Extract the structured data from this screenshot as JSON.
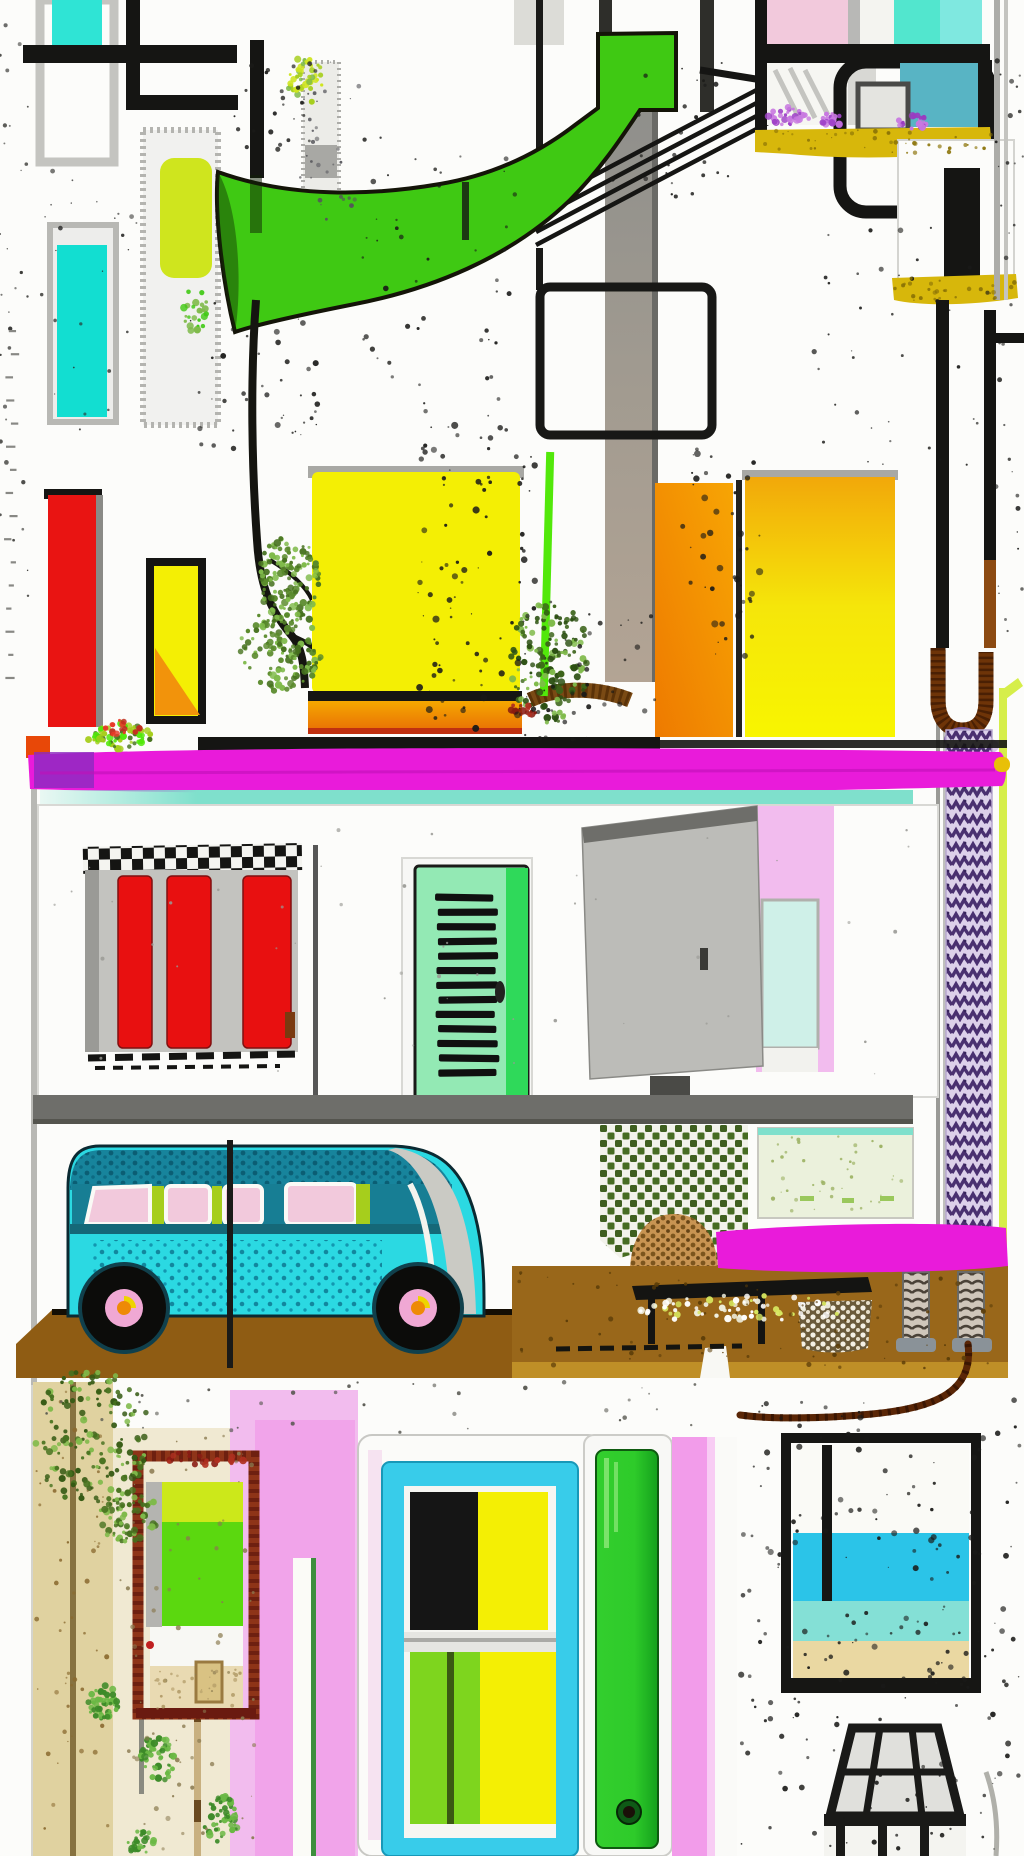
{
  "meta": {
    "width": 1024,
    "height": 1856,
    "title_hidden": ""
  },
  "palette": {
    "white": "#FCFCFA",
    "ink": "#151513",
    "gray-light": "#D8D8D4",
    "gray-mid": "#9A9A96",
    "gray-dark": "#4A4A46",
    "gray-panel": "#C3C3BF",
    "floor-gray": "#6E6E6A",
    "cyan-small": "#2FE4D5",
    "cyan-tall": "#12DED1",
    "chartreuse": "#CFE51E",
    "swoosh-green": "#3FC913",
    "lime": "#A6CE1C",
    "lime-line": "#52E80A",
    "chartreuse-pole-line": "#D6EE4A",
    "yellow": "#F4EF04",
    "amber": "#F2B20C",
    "orange": "#F2930B",
    "orange-deep": "#E86A05",
    "red": "#E91412",
    "red-slat": "#E81010",
    "red-dark": "#B03020",
    "magenta": "#E91BDA",
    "purple": "#8B2BBF",
    "purple-dark": "#4A3070",
    "lavender": "#DCD0EA",
    "pink-light": "#F2BCEE",
    "pink-bright": "#F09EE8",
    "pink-stripe": "#F29CEA",
    "pink-pane": "#F2C9DC",
    "mustard": "#D7B70B",
    "van-cyan": "#2BD9E2",
    "van-teal": "#17849C",
    "van-line": "#156878",
    "aqua-band": "#7FE0CC",
    "mint-pane": "#CFF0E8",
    "mint-door": "#93E9B4",
    "green-stile": "#2FD95A",
    "door-green": "#2ECB2A",
    "door-green-dark": "#14A01C",
    "pane-green": "#7ED51E",
    "sea": "#2BC4E8",
    "sea-aqua": "#84E0D6",
    "sand": "#EAD8A2",
    "plank": "#99671A",
    "plank-light": "#C89A2A",
    "brown-dark": "#6E3408",
    "wire-brown": "#5A2606",
    "tan-path": "#E0D2A0",
    "tan-speckle": "#F0E9D2",
    "taupe": "#B3A494",
    "foliage-dark": "#47721F",
    "foliage-light": "#7FBA4A",
    "rust": "#8C4A12",
    "pale-panel": "#EBF1DC",
    "maroon-frame": "#6E2010"
  },
  "scene": {
    "objects": [
      {
        "name": "top-left-pipes"
      },
      {
        "name": "cyan-window"
      },
      {
        "name": "speckled-column"
      },
      {
        "name": "chartreuse-panel"
      },
      {
        "name": "cyan-panel"
      },
      {
        "name": "red-bar"
      },
      {
        "name": "yellow-bar"
      },
      {
        "name": "green-swoosh"
      },
      {
        "name": "tree"
      },
      {
        "name": "gray-column"
      },
      {
        "name": "black-frame-outline"
      },
      {
        "name": "big-yellow-square"
      },
      {
        "name": "orange-panel"
      },
      {
        "name": "amber-panel"
      },
      {
        "name": "top-right-window"
      },
      {
        "name": "mustard-strips"
      },
      {
        "name": "white-panel"
      },
      {
        "name": "railing"
      },
      {
        "name": "magenta-beam-upper"
      },
      {
        "name": "aqua-trim"
      },
      {
        "name": "slatted-window"
      },
      {
        "name": "shutter-door"
      },
      {
        "name": "open-door"
      },
      {
        "name": "floor-band"
      },
      {
        "name": "purple-pole"
      },
      {
        "name": "brown-bracket"
      },
      {
        "name": "lattice-plant"
      },
      {
        "name": "basket"
      },
      {
        "name": "pale-green-panel"
      },
      {
        "name": "magenta-beam-lower"
      },
      {
        "name": "wooden-deck"
      },
      {
        "name": "wire-table"
      },
      {
        "name": "coil-legs"
      },
      {
        "name": "brown-wire"
      },
      {
        "name": "camper-van"
      },
      {
        "name": "sand-path"
      },
      {
        "name": "pink-wall"
      },
      {
        "name": "garden-bed"
      },
      {
        "name": "center-window"
      },
      {
        "name": "green-door"
      },
      {
        "name": "beach-window"
      },
      {
        "name": "glass-lamp"
      }
    ]
  },
  "decor": {
    "speckle_regions": [
      {
        "x": 360,
        "y": 130,
        "w": 160,
        "h": 300,
        "n": 50,
        "r": 2.2,
        "c": "#1a1a18"
      },
      {
        "x": 415,
        "y": 420,
        "w": 120,
        "h": 310,
        "n": 90,
        "r": 3.0,
        "c": "#1a1a18"
      },
      {
        "x": 188,
        "y": 300,
        "w": 130,
        "h": 150,
        "n": 40,
        "r": 2.5,
        "c": "#1a1a18"
      },
      {
        "x": 680,
        "y": 440,
        "w": 80,
        "h": 220,
        "n": 45,
        "r": 3.0,
        "c": "#1a1a18"
      },
      {
        "x": 610,
        "y": 60,
        "w": 120,
        "h": 150,
        "n": 25,
        "r": 2.0,
        "c": "#1a1a18"
      },
      {
        "x": 810,
        "y": 215,
        "w": 200,
        "h": 255,
        "n": 40,
        "r": 2.2,
        "c": "#1a1a18"
      },
      {
        "x": 995,
        "y": 60,
        "w": 28,
        "h": 620,
        "n": 30,
        "r": 2.0,
        "c": "#1a1a18"
      },
      {
        "x": 40,
        "y": 170,
        "w": 100,
        "h": 260,
        "n": 25,
        "r": 1.8,
        "c": "#2a2a28"
      },
      {
        "x": 232,
        "y": 60,
        "w": 90,
        "h": 90,
        "n": 25,
        "r": 2.0,
        "c": "#1a1a18"
      },
      {
        "x": 300,
        "y": 60,
        "w": 60,
        "h": 170,
        "n": 30,
        "r": 1.8,
        "c": "#55555a"
      },
      {
        "x": 0,
        "y": 0,
        "w": 28,
        "h": 720,
        "n": 30,
        "r": 1.8,
        "c": "#333330"
      },
      {
        "x": 740,
        "y": 1395,
        "w": 280,
        "h": 295,
        "n": 140,
        "r": 2.6,
        "c": "#1a1a18"
      },
      {
        "x": 740,
        "y": 1695,
        "w": 280,
        "h": 155,
        "n": 60,
        "r": 2.4,
        "c": "#1a1a18"
      },
      {
        "x": 45,
        "y": 815,
        "w": 890,
        "h": 265,
        "n": 45,
        "r": 1.4,
        "c": "#999994"
      },
      {
        "x": 520,
        "y": 600,
        "w": 140,
        "h": 140,
        "n": 40,
        "r": 2.2,
        "c": "#1a1a18"
      },
      {
        "x": 120,
        "y": 1430,
        "w": 135,
        "h": 420,
        "n": 70,
        "r": 2.0,
        "c": "#8a7a50"
      },
      {
        "x": 518,
        "y": 1272,
        "w": 486,
        "h": 98,
        "n": 70,
        "r": 2.0,
        "c": "#5a3c08"
      },
      {
        "x": 36,
        "y": 1390,
        "w": 74,
        "h": 460,
        "n": 50,
        "r": 2.0,
        "c": "#8a6a30"
      },
      {
        "x": 764,
        "y": 1136,
        "w": 148,
        "h": 76,
        "n": 40,
        "r": 1.6,
        "c": "#9ab060"
      },
      {
        "x": 35,
        "y": 1378,
        "w": 660,
        "h": 55,
        "n": 35,
        "r": 1.8,
        "c": "#55554e"
      },
      {
        "x": 146,
        "y": 1668,
        "w": 95,
        "h": 42,
        "n": 30,
        "r": 1.5,
        "c": "#b09a66"
      },
      {
        "x": 756,
        "y": 130,
        "w": 236,
        "h": 24,
        "n": 40,
        "r": 1.8,
        "c": "#8a7206"
      },
      {
        "x": 895,
        "y": 278,
        "w": 120,
        "h": 24,
        "n": 30,
        "r": 1.8,
        "c": "#8a7206"
      }
    ],
    "foliage_blobs": [
      {
        "cx": 289,
        "cy": 577,
        "rx": 30,
        "ry": 45,
        "n": 120,
        "pal": [
          "#47721F",
          "#7FBA4A",
          "#5a8a2c"
        ]
      },
      {
        "cx": 281,
        "cy": 650,
        "rx": 42,
        "ry": 42,
        "n": 130,
        "pal": [
          "#47721F",
          "#7FBA4A",
          "#5a8a2c"
        ]
      },
      {
        "cx": 550,
        "cy": 662,
        "rx": 40,
        "ry": 62,
        "n": 150,
        "pal": [
          "#3c641a",
          "#7FBA4A",
          "#2c5012"
        ]
      },
      {
        "cx": 305,
        "cy": 80,
        "rx": 18,
        "ry": 24,
        "n": 40,
        "pal": [
          "#A6CE1C",
          "#7FBA4A",
          "#CFE51E"
        ]
      },
      {
        "cx": 92,
        "cy": 1438,
        "rx": 58,
        "ry": 70,
        "n": 160,
        "pal": [
          "#47721F",
          "#7FBA4A",
          "#355a14"
        ]
      },
      {
        "cx": 128,
        "cy": 1515,
        "rx": 30,
        "ry": 28,
        "n": 70,
        "pal": [
          "#47721F",
          "#7FBA4A"
        ]
      },
      {
        "cx": 103,
        "cy": 1702,
        "rx": 16,
        "ry": 18,
        "n": 45,
        "pal": [
          "#3c8a28",
          "#6ab844"
        ]
      },
      {
        "cx": 158,
        "cy": 1758,
        "rx": 17,
        "ry": 24,
        "n": 50,
        "pal": [
          "#3c8a28",
          "#6ab844"
        ]
      },
      {
        "cx": 222,
        "cy": 1820,
        "rx": 18,
        "ry": 26,
        "n": 50,
        "pal": [
          "#3c8a28",
          "#6ab844"
        ]
      },
      {
        "cx": 140,
        "cy": 1840,
        "rx": 14,
        "ry": 14,
        "n": 30,
        "pal": [
          "#3c8a28",
          "#6ab844"
        ]
      },
      {
        "cx": 118,
        "cy": 736,
        "rx": 34,
        "ry": 13,
        "n": 60,
        "pal": [
          "#A6CE1C",
          "#52E80A",
          "#47721F"
        ]
      },
      {
        "cx": 120,
        "cy": 727,
        "rx": 20,
        "ry": 8,
        "n": 16,
        "pal": [
          "#c03020",
          "#e83a28"
        ]
      },
      {
        "cx": 522,
        "cy": 712,
        "rx": 16,
        "ry": 8,
        "n": 16,
        "pal": [
          "#8a1c10",
          "#b03020"
        ]
      },
      {
        "cx": 788,
        "cy": 116,
        "rx": 22,
        "ry": 9,
        "n": 30,
        "pal": [
          "#a044c8",
          "#c878e0"
        ]
      },
      {
        "cx": 833,
        "cy": 119,
        "rx": 12,
        "ry": 7,
        "n": 18,
        "pal": [
          "#a044c8",
          "#c878e0"
        ]
      },
      {
        "cx": 913,
        "cy": 122,
        "rx": 16,
        "ry": 7,
        "n": 20,
        "pal": [
          "#9a3cc0",
          "#c878e0"
        ]
      },
      {
        "cx": 200,
        "cy": 1460,
        "rx": 48,
        "ry": 8,
        "n": 20,
        "pal": [
          "#b03020",
          "#8a1c14"
        ]
      },
      {
        "cx": 196,
        "cy": 310,
        "rx": 14,
        "ry": 22,
        "n": 26,
        "pal": [
          "#3FC913",
          "#7FBA4A"
        ]
      },
      {
        "cx": 744,
        "cy": 1310,
        "rx": 105,
        "ry": 15,
        "n": 70,
        "pal": [
          "#ffffff",
          "#d8e860",
          "#f0f0e0"
        ]
      }
    ],
    "ticks": {
      "x": 4,
      "y0": 330,
      "y1": 700,
      "n": 16,
      "c": "#888884"
    }
  }
}
